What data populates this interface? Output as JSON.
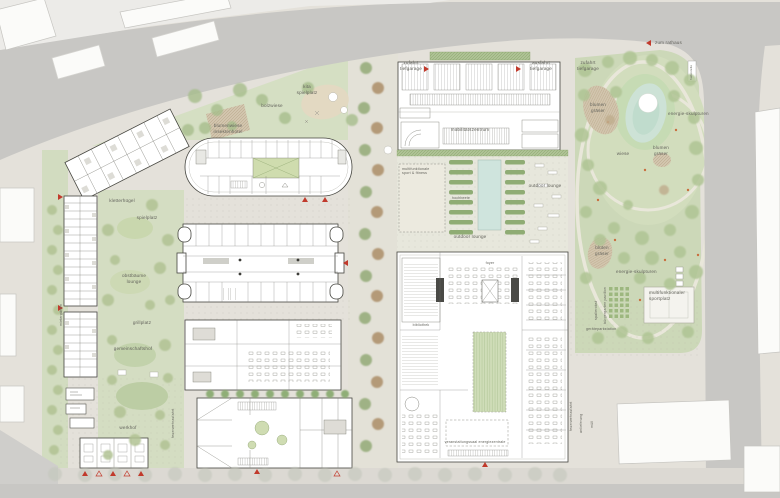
{
  "title": "städtebaulicher lageplan / site plan",
  "colors": {
    "paving": "#e4e1da",
    "road": "#c8c7c4",
    "sidewalk": "#dcd9d3",
    "green": "#ccd8b6",
    "green_light": "#d5dfc3",
    "water": "#cde2d6",
    "building": "#ffffff",
    "outline": "#45453f",
    "accent_red": "#c13a2c",
    "label_text": "#63635c",
    "flower_patch": "#d2c5ae"
  },
  "labels": {
    "zum_rathaus": "zum rathaus",
    "kita_spielplatz": "kita\nspielplatz",
    "bolzwiese": "bolzwiese",
    "blumenwiese_insektenhotel": "blumenwiese\ninsektenhotel",
    "zufahrt_tiefgarage_left": "zufahrt\ntiefgarage",
    "ausfahrt_tiefgarage": "ausfahrt\ntiefgarage",
    "zufahrt_tiefgarage_park": "zufahrt\ntiefgarage",
    "mobilitaetszentrum": "mobilitätszentrum",
    "multifunktionale_sport_fitness": "multifunktionale\nsport & fitness",
    "hochbeete": "hochbeete",
    "outdoor_lounge_1": "outdoor lounge",
    "outdoor_lounge_2": "outdoor lounge",
    "blumen_graeser_1": "blumen\ngräser",
    "blumen_graeser_2": "blumen\ngräser",
    "blumen_graeser_3": "blüten\ngräser",
    "energie_skulpturen_1": "energie-skulpturen",
    "energie_skulpturen_2": "energie-skulpturen",
    "wiese": "wiese",
    "multifunktionaler_sportplatz": "multifunktionaler\nsportplatz",
    "spalierobst": "spalierobst",
    "buergergarten_pavillon": "bürgergarten pavillon",
    "geraeteparkstation": "geräteparkstation",
    "kletterhuegel": "kletterhügel",
    "spielplatz": "spielplatz",
    "obstbaeume_lounge": "obstbäume\nlounge",
    "grillplatz": "grillplatz",
    "gemeinschaftshof": "gemeinschaftshof",
    "werkhof": "werkhof",
    "mietergaerten": "mietergärten",
    "feuerwehrzufahrt_1": "feuerwehrzufahrt",
    "feuerwehrzufahrt_2": "feuerwehrzufahrt",
    "anlieferung": "anlieferung",
    "muell": "müll",
    "veranstaltungssaal": "veranstaltungssaal",
    "energiezentrale": "energiezentrale",
    "foyer": "foyer",
    "bibliothek": "bibliothek",
    "haltestelle": "haltestelle"
  }
}
